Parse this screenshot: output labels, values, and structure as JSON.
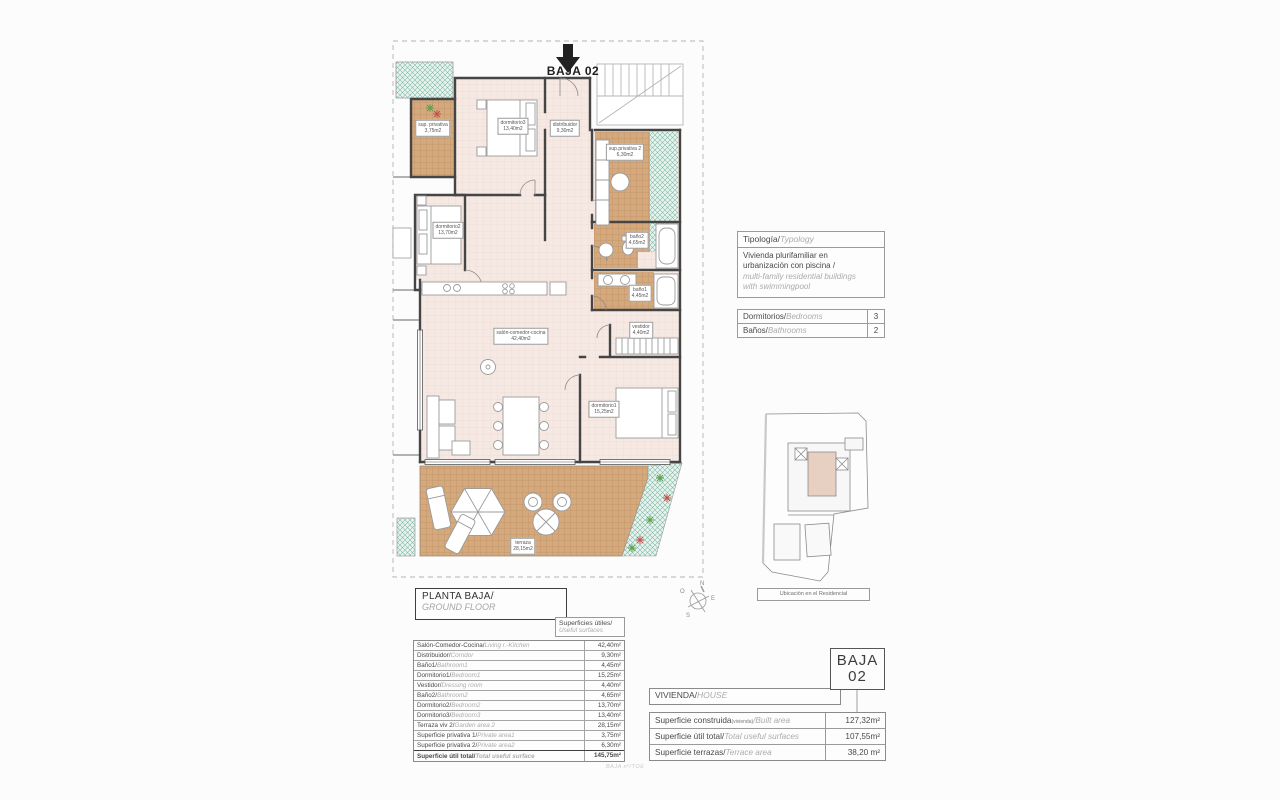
{
  "plan": {
    "arrow_label": "BAJA 02",
    "rooms": [
      {
        "name": "sup. privativa",
        "area": "3,75m2"
      },
      {
        "name": "dormitorio3",
        "area": "13,40m2"
      },
      {
        "name": "distribuidor",
        "area": "9,30m2"
      },
      {
        "name": "sup.privativa 2",
        "area": "6,30m2"
      },
      {
        "name": "baño2",
        "area": "4,65m2"
      },
      {
        "name": "baño1",
        "area": "4,45m2"
      },
      {
        "name": "vestidor",
        "area": "4,40m2"
      },
      {
        "name": "dormitorio2",
        "area": "13,70m2"
      },
      {
        "name": "salón-comedor-cocina",
        "area": "42,40m2"
      },
      {
        "name": "dormitorio1",
        "area": "15,25m2"
      },
      {
        "name": "terraza",
        "area": "28,15m2"
      }
    ],
    "footer_note": "BAJA nº/TOE",
    "colors": {
      "floor_pink": "#f6e9e3",
      "terrace_tan": "#d4a97c",
      "garden_teal": "#7db8a6",
      "wall": "#454545"
    }
  },
  "typology_box": {
    "title_es": "Tipología/",
    "title_en": "Typology",
    "line1": "Vivienda plurifamiliar en",
    "line2": "urbanización con piscina  /",
    "line3": "multi-family residential buildings",
    "line4": "with swimmingpool"
  },
  "counts": {
    "rows": [
      {
        "es": "Dormitorios/",
        "en": "Bedrooms",
        "value": "3"
      },
      {
        "es": "Baños/",
        "en": "Bathrooms",
        "value": "2"
      }
    ]
  },
  "floor_title": {
    "es": "PLANTA BAJA/",
    "en": "GROUND FLOOR"
  },
  "useful_header": {
    "es": "Superficies útiles/",
    "en": "Useful surfaces"
  },
  "useful_table": {
    "rows": [
      {
        "es": "Salón-Comedor-Cocina/",
        "en": "Living r.-Kitchen",
        "value": "42,40m²"
      },
      {
        "es": "Distribuidor/",
        "en": "Corridor",
        "value": "9,30m²"
      },
      {
        "es": "Baño1/",
        "en": "Bathroom1",
        "value": "4,45m²"
      },
      {
        "es": "Dormitorio1/",
        "en": "Bedroom1",
        "value": "15,25m²"
      },
      {
        "es": "Vestidor/",
        "en": "Dressing room",
        "value": "4,40m²"
      },
      {
        "es": "Baño2/",
        "en": "Bathroom2",
        "value": "4,65m²"
      },
      {
        "es": "Dormitorio2/",
        "en": "Bedroom2",
        "value": "13,70m²"
      },
      {
        "es": "Dormitorio3/",
        "en": "Bedroom3",
        "value": "13,40m²"
      },
      {
        "es": "Terraza viv 2/",
        "en": "Garden area 2",
        "value": "28,15m²"
      },
      {
        "es": "Superficie privativa 1/",
        "en": "Private area1",
        "value": "3,75m²"
      },
      {
        "es": "Superficie privativa 2/",
        "en": "Private area2",
        "value": "6,30m²"
      },
      {
        "es": "Superficie útil total/",
        "en": "Total useful surface",
        "value": "145,75m²"
      }
    ]
  },
  "house_box": {
    "es": "VIVIENDA/",
    "en": "HOUSE"
  },
  "house_table": {
    "rows": [
      {
        "es": "Superficie construida",
        "sub": "(vivienda)",
        "en": "/Built area",
        "value": "127,32m²"
      },
      {
        "es": "Superficie útil total/",
        "sub": "",
        "en": "Total useful surfaces",
        "value": "107,55m²"
      },
      {
        "es": "Superficie terrazas/",
        "sub": "",
        "en": "Terrace area",
        "value": "38,20 m²"
      }
    ]
  },
  "unit_badge": {
    "line1": "BAJA",
    "line2": "02"
  },
  "site_map": {
    "caption": "Ubicación en el Residencial"
  },
  "compass": {
    "n": "N",
    "e": "E",
    "s": "S",
    "o": "O"
  }
}
